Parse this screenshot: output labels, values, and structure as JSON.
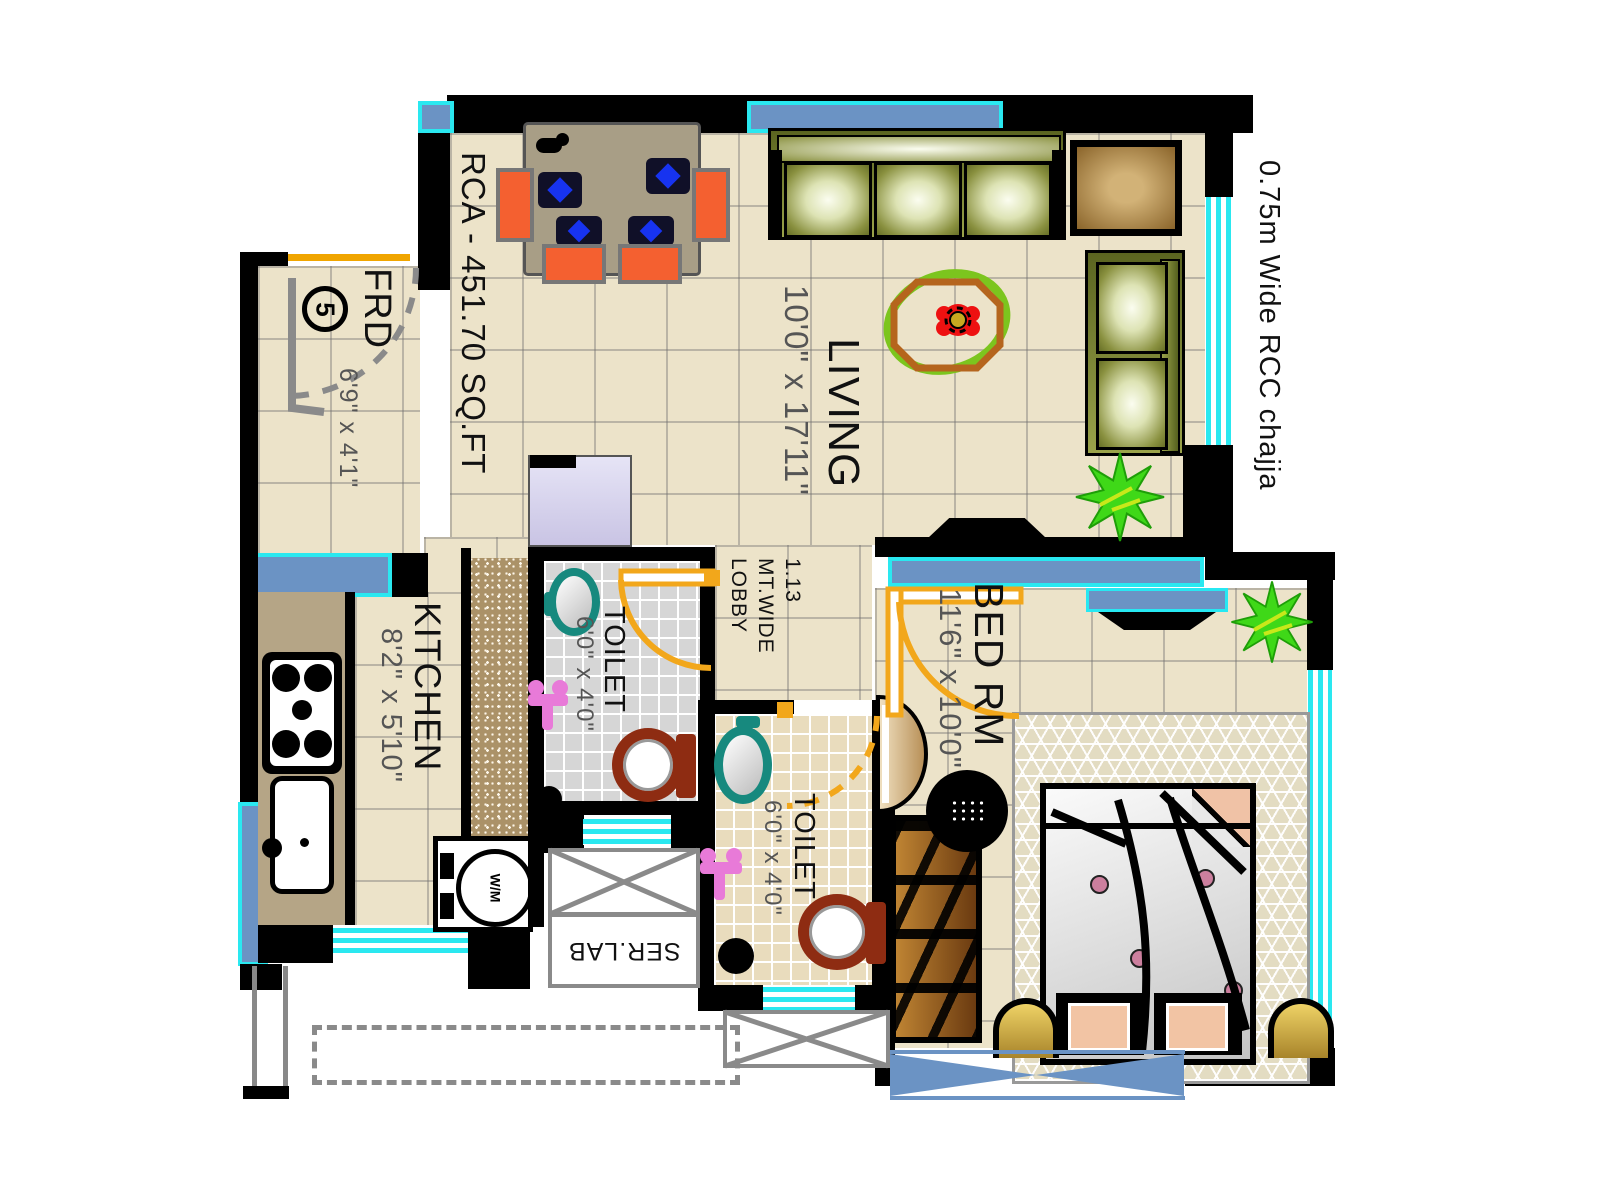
{
  "plan": {
    "title": "1 BHK Apartment Floor Plan",
    "area_note": "RCA - 451.70 SQ.FT",
    "chajja_note": "0.75m Wide RCC chajja",
    "door_number": "5"
  },
  "rooms": {
    "foyer": {
      "label": "FRD",
      "dim": "6'9\" x 4'1\""
    },
    "living": {
      "label": "LIVING",
      "dim": "10'0\" x 17'11\""
    },
    "kitchen": {
      "label": "KITCHEN",
      "dim": "8'2\" x 5'10\""
    },
    "toilet1": {
      "label": "TOILET",
      "dim": "6'0\" x 4'0\""
    },
    "toilet2": {
      "label": "TOILET",
      "dim": "6'0\" x 4'0\""
    },
    "bedroom": {
      "label": "BED RM",
      "dim": "11'6\" x 10'0\""
    },
    "lobby": {
      "label": "1.13\nMT.WIDE\nLOBBY"
    },
    "service": {
      "label": "SER.LAB"
    }
  },
  "appliances": {
    "washing_machine": "W/M"
  },
  "colors": {
    "wall": "#000000",
    "floor": "#ece3c9",
    "window_glass": "#6b93c4",
    "window_trim": "#2ae8f0",
    "door_swing": "#f2a71b",
    "entrance_swing": "#8a8a8a",
    "sofa": "#8a9140",
    "chair": "#f46030",
    "wc": "#8e2c12",
    "basin": "#17897e",
    "fixture_pink": "#e87ad8",
    "plant": "#3fd818",
    "counter": "#b5a586"
  }
}
